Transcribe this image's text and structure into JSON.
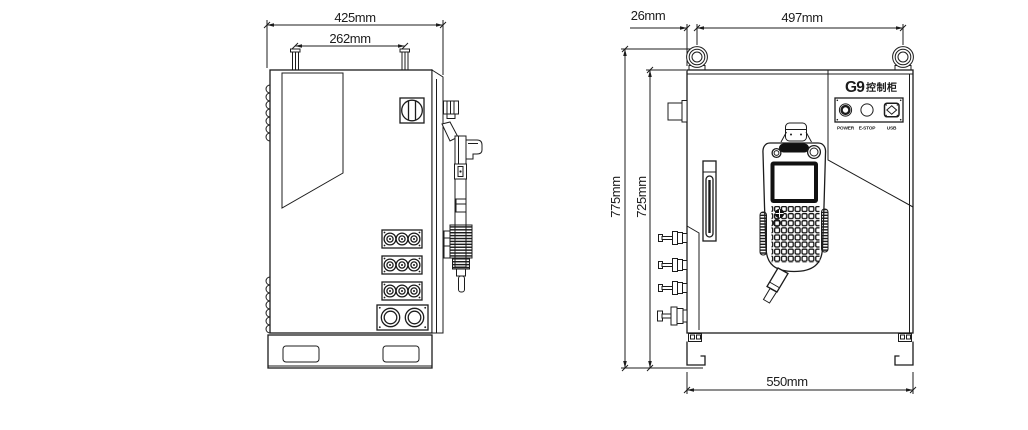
{
  "drawing": {
    "background": "#ffffff",
    "line_color": "#1c1c1c",
    "side_view": {
      "dims": {
        "overall_width": "425mm",
        "handle_span": "262mm"
      }
    },
    "front_view": {
      "dims": {
        "eyebolt_offset": "26mm",
        "eyebolt_span": "497mm",
        "overall_height": "775mm",
        "body_height": "725mm",
        "base_width": "550mm"
      },
      "panel": {
        "model": "G9",
        "model_suffix": "控制柜",
        "labels": {
          "power": "POWER",
          "estop": "E-STOP",
          "usb": "USB"
        }
      }
    }
  }
}
